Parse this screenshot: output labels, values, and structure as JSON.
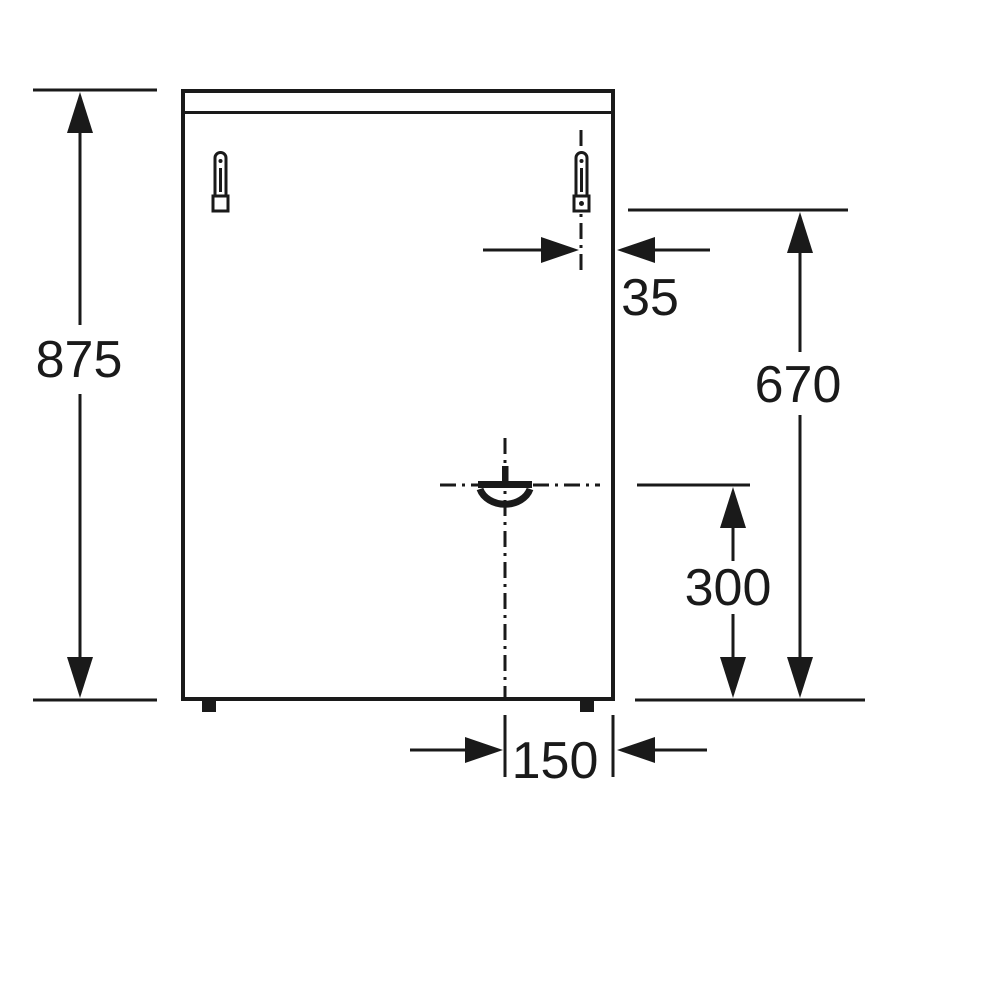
{
  "diagram": {
    "colors": {
      "line": "#1a1a1a",
      "background": "#ffffff"
    },
    "dimensions": {
      "overall_height": {
        "value": "875"
      },
      "bracket_side_offset": {
        "value": "35"
      },
      "bracket_height": {
        "value": "670"
      },
      "gas_connection_height": {
        "value": "300"
      },
      "gas_connection_side_offset": {
        "value": "150"
      }
    }
  }
}
